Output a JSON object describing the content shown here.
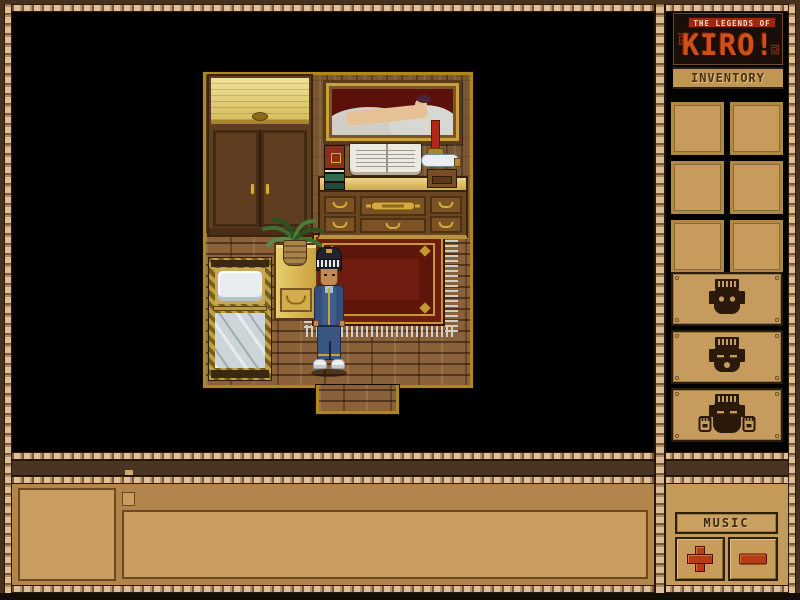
{
  "logo": {
    "tagline": "THE LEGENDS OF",
    "title": "KIRO!"
  },
  "sidebar": {
    "inventory_label": "INVENTORY",
    "inventory_slots": [
      "empty",
      "empty",
      "empty",
      "empty",
      "empty",
      "empty"
    ],
    "emote_buttons": [
      {
        "icon": "tiki-mask-eyes-open-icon"
      },
      {
        "icon": "tiki-mask-sleepy-icon"
      },
      {
        "icon": "tiki-mask-hands-icon"
      }
    ],
    "music": {
      "label": "MUSIC",
      "volume_up_icon": "plus-icon",
      "volume_down_icon": "minus-icon"
    }
  },
  "message_panel": {
    "portrait": "",
    "text": ""
  },
  "scene": {
    "location": "wooden bedroom",
    "objects": [
      "wardrobe",
      "nude-painting",
      "candle",
      "book-stack",
      "open-book",
      "bottle",
      "small-box",
      "desk",
      "hanging-plant",
      "nightstand",
      "bed",
      "red-rug",
      "doorway",
      "player-character"
    ],
    "player": {
      "outfit": "dark helmet with white striped band, blue tracksuit, white sneakers"
    }
  },
  "colors": {
    "frame_brown": "#46311e",
    "braid_light": "#e0c096",
    "panel_tan": "#c59b5d",
    "panel_tan_dark": "#b2854c",
    "accent_red": "#b63c16",
    "logo_orange": "#cf4f16",
    "viewport_bg": "#000000",
    "rug_red": "#6e1d10"
  }
}
